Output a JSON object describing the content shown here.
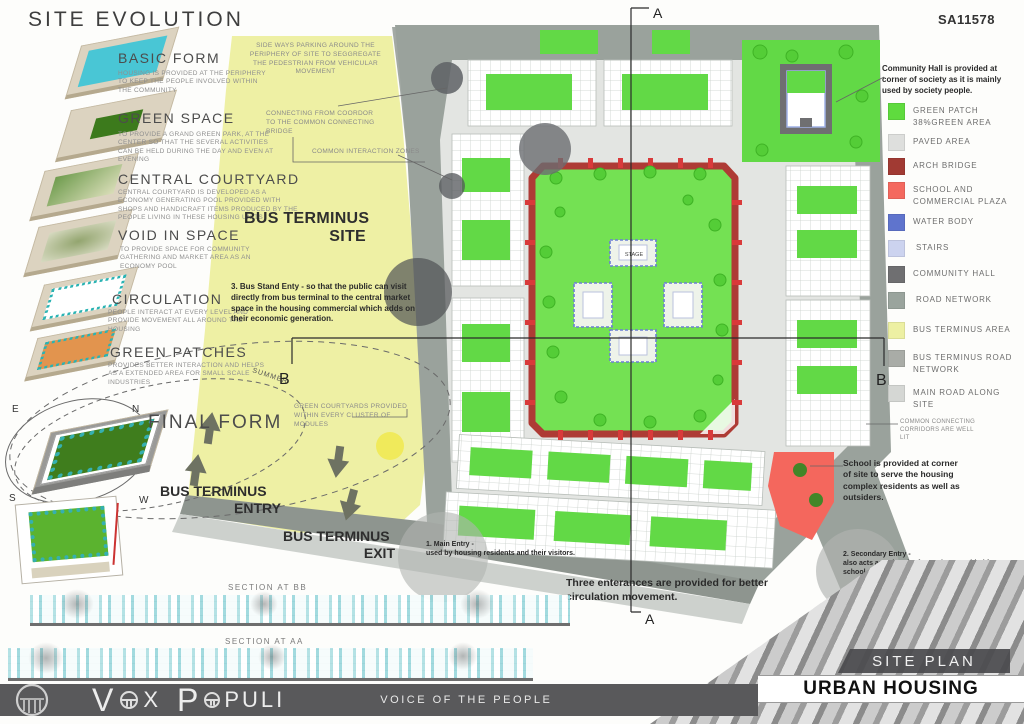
{
  "header": {
    "title": "SITE EVOLUTION",
    "sheet_code": "SA11578"
  },
  "evolution": {
    "final_form_label": "FINAL FORM",
    "steps": [
      {
        "name": "BASIC FORM",
        "desc": "HOUSING IS PROVIDED AT THE PERIPHERY TO KEEP THE PEOPLE INVOLVED WITHIN THE COMMUNITY"
      },
      {
        "name": "GREEN SPACE",
        "desc": "TO PROVIDE A GRAND GREEN PARK, AT THE CENTER SO THAT THE SEVERAL ACTIVITIES CAN BE HELD DURING THE DAY AND EVEN AT EVENING"
      },
      {
        "name": "CENTRAL COURTYARD",
        "desc": "CENTRAL COURTYARD IS DEVELOPED AS A ECONOMY GENERATING POOL PROVIDED WITH SHOPS AND HANDICRAFT ITEMS PRODUCED BY THE PEOPLE LIVING IN THESE HOUSING UNITS"
      },
      {
        "name": "VOID IN SPACE",
        "desc": "TO PROVIDE SPACE FOR COMMUNITY GATHERING AND MARKET AREA AS AN ECONOMY POOL"
      },
      {
        "name": "CIRCULATION",
        "desc": "PEOPLE INTERACT AT EVERY LEVEL AND PROVIDE MOVEMENT ALL AROUND THE HOUSING"
      },
      {
        "name": "GREEN PATCHES",
        "desc": "PROVIDES BETTER INTERACTION AND HELPS AS A EXTENDED AREA FOR SMALL SCALE INDUSTRIES"
      }
    ]
  },
  "compass": {
    "n": "N",
    "e": "E",
    "s": "S",
    "w": "W",
    "summer": "SUMMER",
    "winter": "WINTER"
  },
  "bus_terminus": {
    "site_line1": "BUS TERMINUS",
    "site_line2": "SITE",
    "entry_line1": "BUS TERMINUS",
    "entry_line2": "ENTRY",
    "exit_line1": "BUS TERMINUS",
    "exit_line2": "EXIT",
    "stand_entry_note": "3. Bus Stand Enty - so that the public can visit directly from bus terminal to the central market space in the housing commercial which adds on their economic generation."
  },
  "plan_annotations": {
    "parking": "SIDE WAYS PARKING AROUND THE PERIPHERY OF SITE TO SEGGREGATE THE PEDESTRIAN FROM VEHICULAR MOVEMENT",
    "corridor_bridge": "CONNECTING FROM COORDOR TO THE COMMON CONNECTING BRIDGE",
    "interaction_zones": "COMMON INTERACTION ZONES",
    "green_courtyards": "GREEN COURTYARDS PROVIDED WITHIN EVERY CLUSTER OF MODULES",
    "corridors_lit": "COMMON CONNECTING CORRIDORS ARE WELL LIT",
    "community_hall_note": "Community Hall is provided at corner of society as it is mainly used by society people.",
    "school_note": "School is provided at corner of site to serve the housing complex residents as well as outsiders.",
    "main_entry_title": "1. Main Entry -",
    "main_entry_desc": "used by housing residents and their visitors.",
    "secondary_entry_title": "2. Secondary Entry -",
    "secondary_entry_desc": "also acts as exit point for society provided for school and commercial complex.",
    "entrances_note": "Three enterances are provided for better circulation movement.",
    "stage_label": "STAGE"
  },
  "section_markers": {
    "a_top": "A",
    "a_bottom": "A",
    "b_left": "B",
    "b_right": "B"
  },
  "legend": {
    "items": [
      {
        "label": "GREEN PATCH",
        "sub": "38%GREEN AREA",
        "color": "#5fdb3e"
      },
      {
        "label": "PAVED AREA",
        "sub": "",
        "color": "#dedfdd"
      },
      {
        "label": "ARCH BRIDGE",
        "sub": "",
        "color": "#a13a33"
      },
      {
        "label": "SCHOOL AND COMMERCIAL PLAZA",
        "sub": "",
        "color": "#f4695f"
      },
      {
        "label": "WATER BODY",
        "sub": "",
        "color": "#5f74cd"
      },
      {
        "label": "STAIRS",
        "sub": "",
        "color": "#ccd3ef"
      },
      {
        "label": "COMMUNITY HALL",
        "sub": "",
        "color": "#6f6f71"
      },
      {
        "label": "ROAD NETWORK",
        "sub": "",
        "color": "#9aa49d"
      },
      {
        "label": "BUS TERMINUS AREA",
        "sub": "",
        "color": "#edf0a3"
      },
      {
        "label": "BUS TERMINUS ROAD NETWORK",
        "sub": "",
        "color": "#a9aca7"
      },
      {
        "label": "MAIN ROAD ALONG SITE",
        "sub": "",
        "color": "#d5d7d4"
      }
    ]
  },
  "sections": {
    "bb_label": "SECTION AT BB",
    "aa_label": "SECTION AT AA"
  },
  "plates": {
    "site_plan": "SITE PLAN",
    "project": "URBAN HOUSING"
  },
  "footer": {
    "wordmark": {
      "p1": "V",
      "p2": "X",
      "p3": "P",
      "p4": "PULI"
    },
    "tagline": "VOICE OF THE PEOPLE"
  },
  "colors": {
    "green_patch": "#5fdb3e",
    "paved": "#e3e5e2",
    "arch_bridge": "#ae3b35",
    "school_plaza": "#f4675d",
    "water_body": "#5f74cd",
    "stairs": "#ccd3ef",
    "community_hall": "#6f6f71",
    "road": "#9aa29c",
    "bus_area": "#eef0a4",
    "bus_road": "#a3a9a4",
    "main_road": "#cdd1cd",
    "footer_bar": "#59595b",
    "sun": "#f0e94f"
  }
}
